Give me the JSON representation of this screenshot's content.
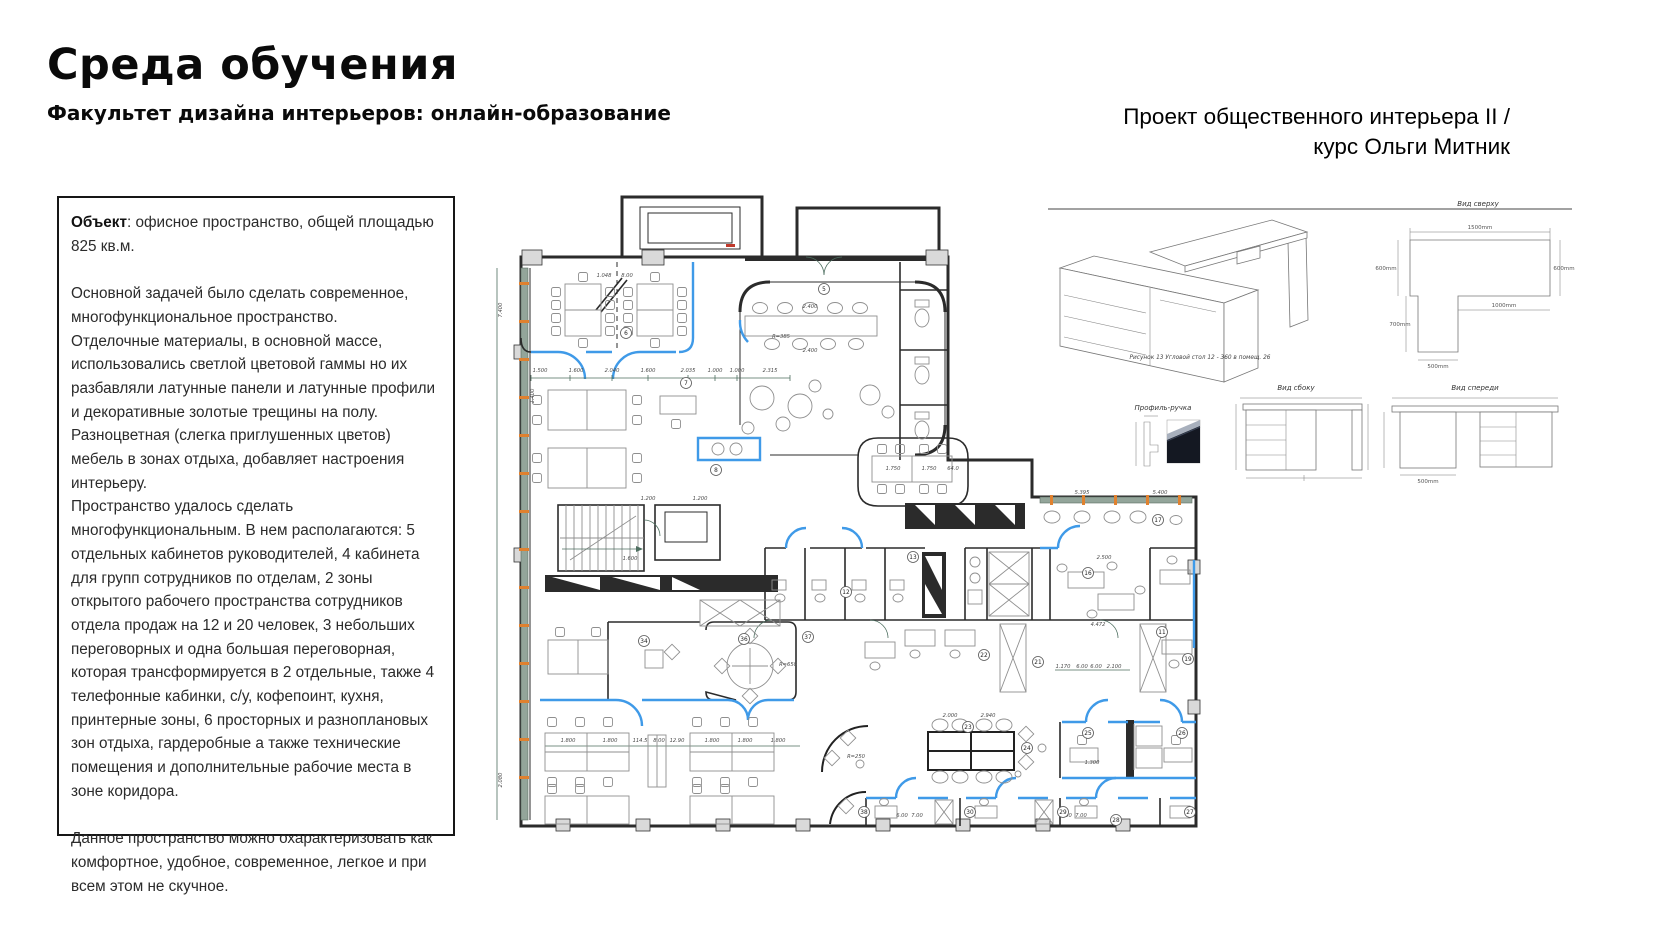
{
  "header": {
    "title": "Среда обучения",
    "subtitle": "Факультет дизайна интерьеров: онлайн-образование",
    "project_line1": "Проект общественного интерьера II /",
    "project_line2": "курс Ольги Митник"
  },
  "description_box": {
    "object_label": "Объект",
    "object_text": ": офисное пространство, общей площадью 825 кв.м.",
    "paragraphs": [
      "Основной задачей было сделать современное, многофункциональное пространство.",
      "Отделочные материалы, в основной массе, использовались светлой цветовой гаммы но их разбавляли латунные панели и латунные профили и декоративные золотые трещины на полу.",
      "Разноцветная  (слегка приглушенных цветов) мебель в зонах отдыха, добавляет настроения интерьеру.",
      "Пространство удалось сделать многофункциональным. В нем располагаются: 5 отдельных кабинетов руководителей,  4 кабинета для групп сотрудников по отделам, 2 зоны открытого рабочего пространства сотрудников отдела продаж на 12 и 20 человек, 3 небольших переговорных и одна большая переговорная, которая трансформируется в 2 отдельные, также 4 телефонные кабинки, с/у, кофепоинт, кухня, принтерные зоны, 6 просторных и разноплановых зон отдыха, гардеробные а также технические помещения  и дополнительные рабочие места в зоне коридора.",
      "",
      "Данное пространство можно охарактеризовать как комфортное, удобное, современное, легкое и при всем этом не скучное."
    ]
  },
  "furniture_panel": {
    "caption": "Рисунок 13 Угловой стол 12 - 360 в помещ. 26",
    "top_view_label": "Вид сверху",
    "side_view_label": "Вид сбоку",
    "front_view_label": "Вид спереди",
    "handle_label": "Профиль-ручка",
    "top_view_dims": {
      "top": "1500mm",
      "left": "600mm",
      "right": "600mm",
      "inner": "1000mm",
      "leg": "700mm",
      "bottom": "500mm"
    },
    "front_view_dim": "500mm"
  },
  "colors": {
    "accent_blue": "#3f9ae8",
    "window_green": "#93a59a",
    "tick_orange": "#e0812f",
    "wall": "#2b2b2b",
    "furniture_gray": "#8f8f8f",
    "dim_text": "#4a4a4a"
  },
  "floor_plan": {
    "room_numbers": [
      {
        "n": "5",
        "x": 824,
        "y": 289
      },
      {
        "n": "6",
        "x": 626,
        "y": 333
      },
      {
        "n": "7",
        "x": 686,
        "y": 383
      },
      {
        "n": "8",
        "x": 716,
        "y": 470
      },
      {
        "n": "11",
        "x": 1162,
        "y": 632
      },
      {
        "n": "12",
        "x": 846,
        "y": 592
      },
      {
        "n": "13",
        "x": 913,
        "y": 557
      },
      {
        "n": "16",
        "x": 1088,
        "y": 573
      },
      {
        "n": "17",
        "x": 1158,
        "y": 520
      },
      {
        "n": "19",
        "x": 1188,
        "y": 659
      },
      {
        "n": "21",
        "x": 1038,
        "y": 662
      },
      {
        "n": "22",
        "x": 984,
        "y": 655
      },
      {
        "n": "23",
        "x": 968,
        "y": 727
      },
      {
        "n": "24",
        "x": 1027,
        "y": 748
      },
      {
        "n": "25",
        "x": 1088,
        "y": 733
      },
      {
        "n": "26",
        "x": 1182,
        "y": 733
      },
      {
        "n": "27",
        "x": 1190,
        "y": 812
      },
      {
        "n": "28",
        "x": 1116,
        "y": 820
      },
      {
        "n": "29",
        "x": 1063,
        "y": 812
      },
      {
        "n": "30",
        "x": 970,
        "y": 812
      },
      {
        "n": "34",
        "x": 644,
        "y": 641
      },
      {
        "n": "36",
        "x": 744,
        "y": 639
      },
      {
        "n": "37",
        "x": 808,
        "y": 637
      },
      {
        "n": "38",
        "x": 864,
        "y": 812
      }
    ],
    "dim_labels": [
      {
        "t": "1.048",
        "x": 604,
        "y": 277
      },
      {
        "t": "8.00",
        "x": 627,
        "y": 277
      },
      {
        "t": "1.500",
        "x": 540,
        "y": 372
      },
      {
        "t": "1.600",
        "x": 576,
        "y": 372
      },
      {
        "t": "2.040",
        "x": 612,
        "y": 372
      },
      {
        "t": "1.600",
        "x": 648,
        "y": 372
      },
      {
        "t": "2.035",
        "x": 688,
        "y": 372
      },
      {
        "t": "1.000",
        "x": 715,
        "y": 372
      },
      {
        "t": "1.000",
        "x": 737,
        "y": 372
      },
      {
        "t": "2.315",
        "x": 770,
        "y": 372
      },
      {
        "t": "2.400",
        "x": 810,
        "y": 308
      },
      {
        "t": "2.400",
        "x": 810,
        "y": 352
      },
      {
        "t": "1.750",
        "x": 893,
        "y": 470
      },
      {
        "t": "1.750",
        "x": 929,
        "y": 470
      },
      {
        "t": "64.0",
        "x": 953,
        "y": 470
      },
      {
        "t": "R=385",
        "x": 781,
        "y": 338
      },
      {
        "t": "1.200",
        "x": 648,
        "y": 500
      },
      {
        "t": "1.200",
        "x": 700,
        "y": 500
      },
      {
        "t": "5.395",
        "x": 1082,
        "y": 494
      },
      {
        "t": "5.400",
        "x": 1160,
        "y": 494
      },
      {
        "t": "2.500",
        "x": 1104,
        "y": 559
      },
      {
        "t": "4.472",
        "x": 1098,
        "y": 626
      },
      {
        "t": "1.170",
        "x": 1063,
        "y": 668
      },
      {
        "t": "6.00",
        "x": 1082,
        "y": 668
      },
      {
        "t": "6.00",
        "x": 1096,
        "y": 668
      },
      {
        "t": "2.100",
        "x": 1114,
        "y": 668
      },
      {
        "t": "2.000",
        "x": 950,
        "y": 717
      },
      {
        "t": "2.940",
        "x": 988,
        "y": 717
      },
      {
        "t": "1.800",
        "x": 568,
        "y": 742
      },
      {
        "t": "1.800",
        "x": 610,
        "y": 742
      },
      {
        "t": "114.5",
        "x": 640,
        "y": 742
      },
      {
        "t": "8.00",
        "x": 659,
        "y": 742
      },
      {
        "t": "12.90",
        "x": 677,
        "y": 742
      },
      {
        "t": "1.800",
        "x": 712,
        "y": 742
      },
      {
        "t": "1.800",
        "x": 745,
        "y": 742
      },
      {
        "t": "1.800",
        "x": 778,
        "y": 742
      },
      {
        "t": "R=650",
        "x": 788,
        "y": 666
      },
      {
        "t": "R=250",
        "x": 856,
        "y": 758
      },
      {
        "t": "1.300",
        "x": 1092,
        "y": 764
      },
      {
        "t": "1.600",
        "x": 630,
        "y": 560
      },
      {
        "t": "6.00",
        "x": 902,
        "y": 817
      },
      {
        "t": "7.00",
        "x": 917,
        "y": 817
      },
      {
        "t": "6.00",
        "x": 1066,
        "y": 817
      },
      {
        "t": "7.00",
        "x": 1081,
        "y": 817
      },
      {
        "t": "7.400",
        "x": 502,
        "y": 310,
        "v": true
      },
      {
        "t": "1.400",
        "x": 534,
        "y": 396,
        "v": true
      },
      {
        "t": "2.080",
        "x": 502,
        "y": 780,
        "v": true
      }
    ]
  }
}
